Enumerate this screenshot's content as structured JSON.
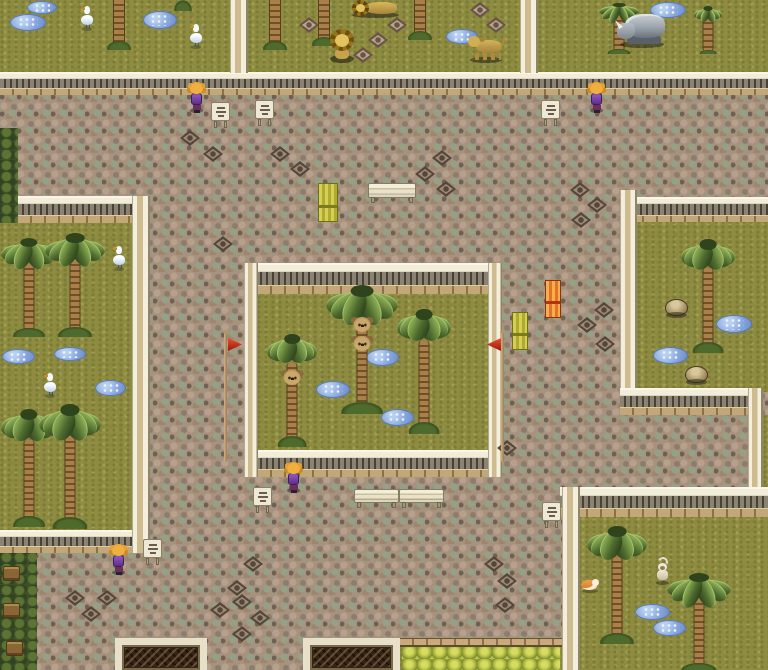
{
  "meta": {
    "viewport_w": 768,
    "viewport_h": 670,
    "scene_kind": "top-down-rpg-zoo-map"
  },
  "palette": {
    "grass": "#8f8c42",
    "path": "#a5937f",
    "wall_cream": "#f2ecda",
    "wall_brick": "#c2a878",
    "wall_slat": "#8a8272",
    "water": "#86a4dc",
    "banner_yellow": "#c9c34a",
    "banner_orange": "#e8883c",
    "flag_red": "#d83818",
    "hedge_dark": "#3f4f26",
    "hedgerow_light": "#aab842",
    "npc_hair": "#e8a030",
    "npc_dress": "#6a3898"
  },
  "scene": {
    "layers": [
      {
        "name": "terrain",
        "items": [
          {
            "t": "path",
            "kind": "cobblestone-path",
            "x": 0,
            "y": 0,
            "w": 768,
            "h": 670
          },
          {
            "t": "grass",
            "kind": "pen-topleft-cranes",
            "x": 0,
            "y": 0,
            "w": 232,
            "h": 77
          },
          {
            "t": "grass",
            "kind": "pen-top-lions",
            "x": 248,
            "y": 0,
            "w": 274,
            "h": 77
          },
          {
            "t": "grass",
            "kind": "pen-top-rhino",
            "x": 538,
            "y": 0,
            "w": 230,
            "h": 77
          },
          {
            "t": "grass",
            "kind": "pen-left-cranes",
            "x": 0,
            "y": 223,
            "w": 133,
            "h": 310
          },
          {
            "t": "grass",
            "kind": "pen-central-koalas",
            "x": 250,
            "y": 290,
            "w": 246,
            "h": 166
          },
          {
            "t": "grass",
            "kind": "pen-right",
            "x": 637,
            "y": 220,
            "w": 131,
            "h": 172
          },
          {
            "t": "grass",
            "kind": "east-edge-strip",
            "x": 763,
            "y": 415,
            "w": 5,
            "h": 72
          },
          {
            "t": "grass",
            "kind": "pen-bottomright-monkey",
            "x": 578,
            "y": 515,
            "w": 190,
            "h": 155
          },
          {
            "t": "grass",
            "kind": "south-lawn",
            "x": 400,
            "y": 638,
            "w": 162,
            "h": 32
          },
          {
            "t": "hedge",
            "kind": "west-hedge",
            "x": 0,
            "y": 128,
            "w": 18,
            "h": 95
          },
          {
            "t": "hedge",
            "kind": "southwest-hedge",
            "x": 0,
            "y": 553,
            "w": 37,
            "h": 117
          },
          {
            "t": "hedgerow",
            "kind": "south-hedgerow",
            "x": 402,
            "y": 646,
            "w": 158,
            "h": 24
          },
          {
            "t": "ledge",
            "kind": "south-brick-ledge",
            "x": 400,
            "y": 638,
            "w": 162,
            "h": 9
          }
        ]
      },
      {
        "name": "walls",
        "items": [
          {
            "t": "wallh",
            "x": 0,
            "y": 72,
            "w": 768,
            "h": 23
          },
          {
            "t": "wallv",
            "x": 230,
            "y": 0,
            "w": 18,
            "h": 73
          },
          {
            "t": "wallv",
            "x": 520,
            "y": 0,
            "w": 18,
            "h": 73
          },
          {
            "t": "wallh",
            "x": 18,
            "y": 196,
            "w": 132,
            "h": 27
          },
          {
            "t": "wallh",
            "x": 0,
            "y": 530,
            "w": 150,
            "h": 23
          },
          {
            "t": "wallv",
            "x": 132,
            "y": 196,
            "w": 18,
            "h": 357
          },
          {
            "t": "wallh",
            "x": 244,
            "y": 263,
            "w": 258,
            "h": 31
          },
          {
            "t": "wallh",
            "x": 244,
            "y": 450,
            "w": 258,
            "h": 27
          },
          {
            "t": "wallv",
            "x": 244,
            "y": 263,
            "w": 14,
            "h": 214
          },
          {
            "t": "wallv",
            "x": 488,
            "y": 263,
            "w": 14,
            "h": 214
          },
          {
            "t": "wallh",
            "x": 630,
            "y": 197,
            "w": 138,
            "h": 25
          },
          {
            "t": "wallv",
            "x": 620,
            "y": 190,
            "w": 17,
            "h": 225
          },
          {
            "t": "wallh",
            "x": 620,
            "y": 388,
            "w": 143,
            "h": 27
          },
          {
            "t": "wallv",
            "x": 748,
            "y": 388,
            "w": 15,
            "h": 129
          },
          {
            "t": "wallh",
            "x": 560,
            "y": 487,
            "w": 208,
            "h": 30
          },
          {
            "t": "wallv",
            "x": 562,
            "y": 487,
            "w": 18,
            "h": 183
          }
        ]
      },
      {
        "name": "ground-marks",
        "items": [
          {
            "t": "puddle",
            "x": 10,
            "y": 14,
            "w": 36,
            "h": 17
          },
          {
            "t": "puddle",
            "x": 27,
            "y": 1,
            "w": 30,
            "h": 13
          },
          {
            "t": "puddle",
            "x": 143,
            "y": 11,
            "w": 34,
            "h": 18
          },
          {
            "t": "puddle",
            "x": 446,
            "y": 29,
            "w": 32,
            "h": 15
          },
          {
            "t": "puddle",
            "x": 650,
            "y": 2,
            "w": 36,
            "h": 16
          },
          {
            "t": "puddle",
            "x": 2,
            "y": 349,
            "w": 33,
            "h": 15
          },
          {
            "t": "puddle",
            "x": 54,
            "y": 347,
            "w": 32,
            "h": 14
          },
          {
            "t": "puddle",
            "x": 95,
            "y": 380,
            "w": 31,
            "h": 16
          },
          {
            "t": "puddle",
            "x": 366,
            "y": 349,
            "w": 33,
            "h": 17
          },
          {
            "t": "puddle",
            "x": 316,
            "y": 381,
            "w": 34,
            "h": 17
          },
          {
            "t": "puddle",
            "x": 381,
            "y": 409,
            "w": 33,
            "h": 17
          },
          {
            "t": "puddle",
            "x": 716,
            "y": 315,
            "w": 36,
            "h": 18
          },
          {
            "t": "puddle",
            "x": 653,
            "y": 347,
            "w": 35,
            "h": 17
          },
          {
            "t": "puddle",
            "x": 635,
            "y": 604,
            "w": 35,
            "h": 16
          },
          {
            "t": "puddle",
            "x": 653,
            "y": 620,
            "w": 33,
            "h": 16
          },
          {
            "t": "dia",
            "x": 180,
            "y": 130
          },
          {
            "t": "dia",
            "x": 203,
            "y": 146
          },
          {
            "t": "dia",
            "x": 270,
            "y": 146
          },
          {
            "t": "dia",
            "x": 290,
            "y": 161
          },
          {
            "t": "dia",
            "x": 432,
            "y": 150
          },
          {
            "t": "dia",
            "x": 415,
            "y": 166
          },
          {
            "t": "dia",
            "x": 436,
            "y": 181
          },
          {
            "t": "dia",
            "x": 570,
            "y": 182
          },
          {
            "t": "dia",
            "x": 587,
            "y": 197
          },
          {
            "t": "dia",
            "x": 571,
            "y": 212
          },
          {
            "t": "dia",
            "x": 213,
            "y": 236
          },
          {
            "t": "dia",
            "x": 594,
            "y": 302
          },
          {
            "t": "dia",
            "x": 577,
            "y": 317
          },
          {
            "t": "dia",
            "x": 595,
            "y": 336
          },
          {
            "t": "dia",
            "x": 497,
            "y": 440
          },
          {
            "t": "dia",
            "x": 484,
            "y": 556
          },
          {
            "t": "dia",
            "x": 497,
            "y": 573
          },
          {
            "t": "dia",
            "x": 65,
            "y": 590
          },
          {
            "t": "dia",
            "x": 97,
            "y": 590
          },
          {
            "t": "dia",
            "x": 81,
            "y": 606
          },
          {
            "t": "dia",
            "x": 227,
            "y": 580
          },
          {
            "t": "dia",
            "x": 210,
            "y": 602
          },
          {
            "t": "dia",
            "x": 243,
            "y": 556
          },
          {
            "t": "dia",
            "x": 232,
            "y": 594
          },
          {
            "t": "dia",
            "x": 250,
            "y": 610
          },
          {
            "t": "dia",
            "x": 232,
            "y": 626
          },
          {
            "t": "dia",
            "x": 495,
            "y": 597
          },
          {
            "t": "dia",
            "v": "g",
            "x": 299,
            "y": 17
          },
          {
            "t": "dia",
            "v": "g",
            "x": 387,
            "y": 17
          },
          {
            "t": "dia",
            "v": "g",
            "x": 368,
            "y": 32
          },
          {
            "t": "dia",
            "v": "g",
            "x": 353,
            "y": 47
          },
          {
            "t": "dia",
            "v": "g",
            "x": 470,
            "y": 2
          },
          {
            "t": "dia",
            "v": "g",
            "x": 486,
            "y": 17
          }
        ]
      },
      {
        "name": "props",
        "items": [
          {
            "t": "bench",
            "x": 368,
            "y": 183,
            "w": 48,
            "h": 20
          },
          {
            "t": "bench",
            "x": 354,
            "y": 489,
            "w": 45,
            "h": 19
          },
          {
            "t": "bench",
            "x": 399,
            "y": 489,
            "w": 45,
            "h": 19
          },
          {
            "t": "banner",
            "kind": "banner-yellow",
            "x": 318,
            "y": 183,
            "w": 20,
            "h": 39
          },
          {
            "t": "banner",
            "kind": "banner-orange",
            "v": "or",
            "x": 545,
            "y": 280,
            "w": 16,
            "h": 38
          },
          {
            "t": "banner",
            "kind": "banner-yellow",
            "x": 512,
            "y": 312,
            "w": 16,
            "h": 38
          },
          {
            "t": "sign",
            "x": 211,
            "y": 102,
            "w": 19,
            "h": 26
          },
          {
            "t": "sign",
            "x": 255,
            "y": 100,
            "w": 19,
            "h": 26
          },
          {
            "t": "sign",
            "x": 541,
            "y": 100,
            "w": 19,
            "h": 26
          },
          {
            "t": "sign",
            "x": 253,
            "y": 487,
            "w": 19,
            "h": 26
          },
          {
            "t": "sign",
            "x": 542,
            "y": 502,
            "w": 19,
            "h": 26
          },
          {
            "t": "sign",
            "x": 143,
            "y": 539,
            "w": 19,
            "h": 26
          },
          {
            "t": "flag",
            "kind": "red-flagpole",
            "x": 221,
            "y": 330
          },
          {
            "t": "flag",
            "kind": "red-flagpole",
            "v": "lf",
            "x": 487,
            "y": 330
          },
          {
            "t": "gate",
            "kind": "south-gate-west",
            "x": 115,
            "y": 638,
            "w": 92,
            "h": 32
          },
          {
            "t": "gate",
            "kind": "south-gate-east",
            "x": 303,
            "y": 638,
            "w": 97,
            "h": 32
          },
          {
            "t": "crate",
            "x": 3,
            "y": 566
          },
          {
            "t": "crate",
            "x": 3,
            "y": 603
          },
          {
            "t": "crate",
            "x": 6,
            "y": 641
          },
          {
            "t": "rock",
            "x": 664,
            "y": 298
          },
          {
            "t": "rock",
            "x": 684,
            "y": 365
          },
          {
            "t": "tuft",
            "x": 174,
            "y": 0
          }
        ]
      },
      {
        "name": "trees",
        "items": [
          {
            "t": "ptrunk",
            "x": 110,
            "y": 0,
            "w": 18,
            "h": 48
          },
          {
            "t": "ptrunk",
            "x": 266,
            "y": 0,
            "w": 18,
            "h": 48
          },
          {
            "t": "ptrunk",
            "x": 315,
            "y": 0,
            "w": 18,
            "h": 44
          },
          {
            "t": "ptrunk",
            "x": 411,
            "y": 0,
            "w": 18,
            "h": 38
          },
          {
            "t": "palm",
            "x": 598,
            "y": 0,
            "w": 42,
            "h": 52
          },
          {
            "t": "palm",
            "x": 693,
            "y": 4,
            "w": 30,
            "h": 48
          },
          {
            "t": "palm",
            "x": 0,
            "y": 233,
            "w": 58,
            "h": 102
          },
          {
            "t": "palm",
            "x": 44,
            "y": 228,
            "w": 62,
            "h": 107
          },
          {
            "t": "palm",
            "x": 0,
            "y": 403,
            "w": 58,
            "h": 122
          },
          {
            "t": "palm",
            "x": 38,
            "y": 398,
            "w": 64,
            "h": 129
          },
          {
            "t": "palm",
            "x": 266,
            "y": 328,
            "w": 52,
            "h": 117,
            "koalas": [
              36
            ]
          },
          {
            "t": "palm",
            "x": 324,
            "y": 278,
            "w": 76,
            "h": 134,
            "koalas": [
              29,
              43
            ]
          },
          {
            "t": "palm",
            "x": 396,
            "y": 302,
            "w": 56,
            "h": 130
          },
          {
            "t": "palm",
            "x": 680,
            "y": 233,
            "w": 56,
            "h": 118
          },
          {
            "t": "palm",
            "x": 586,
            "y": 520,
            "w": 62,
            "h": 122
          },
          {
            "t": "palm",
            "x": 666,
            "y": 568,
            "w": 66,
            "h": 102
          }
        ]
      },
      {
        "name": "actors",
        "items": [
          {
            "t": "animal",
            "kind": "crane",
            "x": 80,
            "y": 6
          },
          {
            "t": "animal",
            "kind": "crane",
            "x": 189,
            "y": 24
          },
          {
            "t": "animal",
            "kind": "crane",
            "x": 112,
            "y": 246
          },
          {
            "t": "animal",
            "kind": "crane",
            "x": 43,
            "y": 373
          },
          {
            "t": "animal",
            "kind": "lion-lying",
            "x": 352,
            "y": 0
          },
          {
            "t": "animal",
            "kind": "lion-sitting",
            "x": 329,
            "y": 29
          },
          {
            "t": "animal",
            "kind": "lioness",
            "x": 468,
            "y": 36
          },
          {
            "t": "animal",
            "kind": "rhino",
            "x": 617,
            "y": 11
          },
          {
            "t": "animal",
            "kind": "hamster",
            "x": 581,
            "y": 578
          },
          {
            "t": "animal",
            "kind": "monkey",
            "x": 654,
            "y": 557
          },
          {
            "t": "npc",
            "kind": "npc-girl-north-west",
            "x": 188,
            "y": 82
          },
          {
            "t": "npc",
            "kind": "npc-girl-north-east",
            "x": 588,
            "y": 82
          },
          {
            "t": "npc",
            "kind": "npc-girl-center",
            "x": 285,
            "y": 462
          },
          {
            "t": "npc",
            "kind": "npc-girl-south",
            "x": 110,
            "y": 544
          }
        ]
      }
    ]
  }
}
